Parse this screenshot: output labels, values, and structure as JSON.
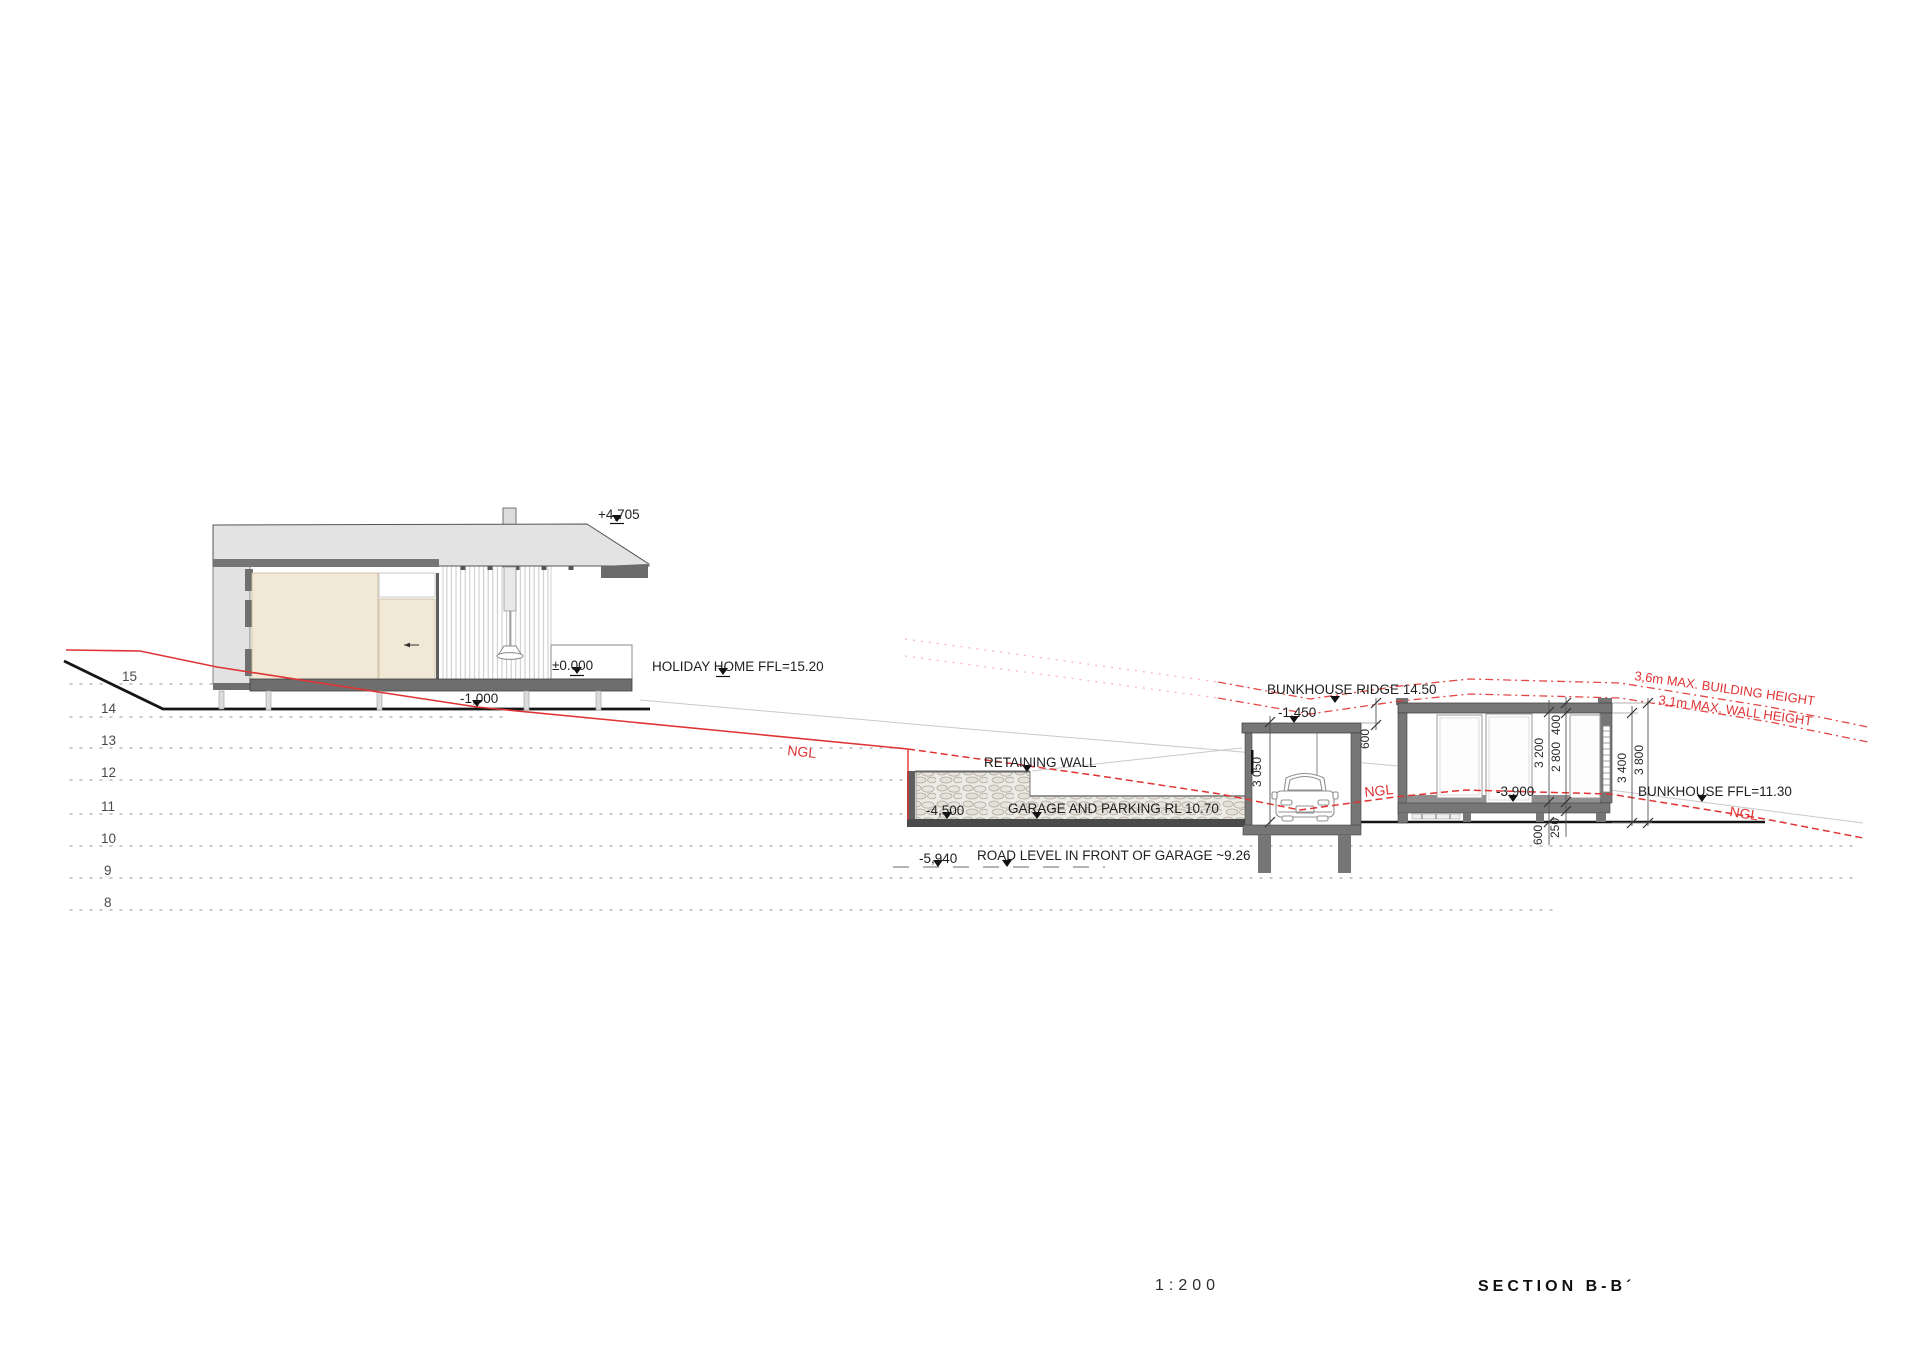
{
  "page": {
    "scale_label": "1:200",
    "title": "SECTION B-B´"
  },
  "colors": {
    "accent_red": "#e03434",
    "slab_gray": "#767676",
    "roof_gray": "#e3e3e3",
    "beige": "#f1e8d5",
    "grid_gray": "#b5b5b5",
    "terrain_black": "#151515"
  },
  "grid": {
    "levels": [
      "15",
      "14",
      "13",
      "12",
      "11",
      "10",
      "9",
      "8"
    ]
  },
  "holiday_home": {
    "ridge_level": "+4,705",
    "zero_level": "±0.000",
    "ffl_label": "HOLIDAY HOME FFL=15.20",
    "minus_one": "-1,000"
  },
  "site": {
    "ngl_label_1": "NGL",
    "ngl_label_2": "NGL",
    "ngl_label_3": "NGL",
    "retaining_wall_label": "RETAINING WALL",
    "minus_4500": "-4,500",
    "garage_parking_label": "GARAGE AND PARKING RL 10.70",
    "minus_5940": "-5,940",
    "road_level_label": "ROAD LEVEL IN FRONT OF GARAGE ~9.26",
    "max_building_height": "3,6m  MAX. BUILDING HEIGHT",
    "max_wall_height": "3,1m MAX. WALL HEIGHT"
  },
  "garage": {
    "dim_height": "3 050",
    "dim_roof_offset": "600"
  },
  "bunkhouse": {
    "ridge_label": "BUNKHOUSE RIDGE 14.50",
    "minus_1450": "-1,450",
    "minus_3900": "-3,900",
    "ffl_label": "BUNKHOUSE FFL=11.30",
    "dim_wall": "3 200",
    "dim_clear": "2 800",
    "dim_roof": "400",
    "dim_plinth": "600",
    "dim_slab": "250",
    "dim_3400": "3 400",
    "dim_3800": "3 800"
  }
}
